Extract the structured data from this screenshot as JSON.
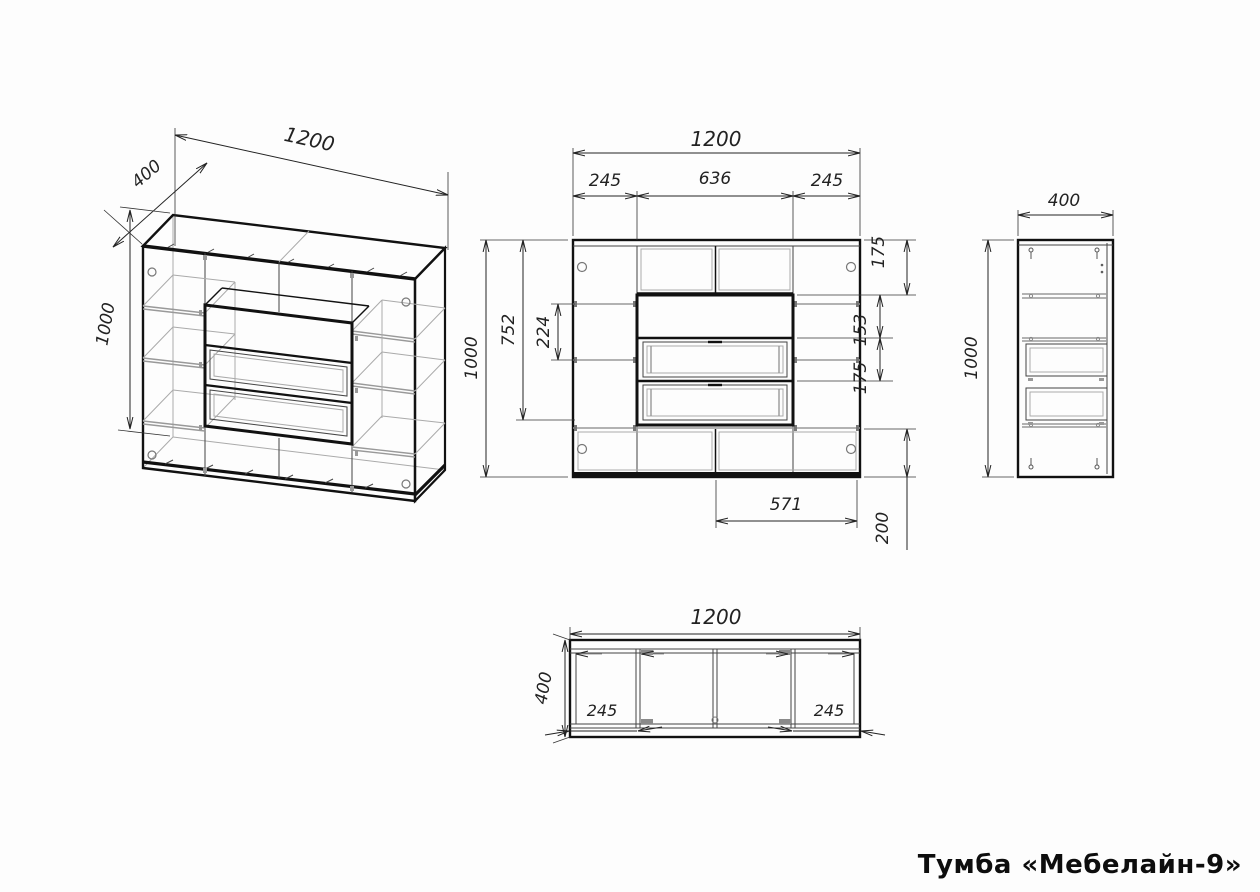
{
  "title": "Тумба «Мебелайн-9»",
  "drawing": {
    "isometric": {
      "width": "1200",
      "depth": "400",
      "height": "1000"
    },
    "front": {
      "overall_width": "1200",
      "left_bay": "245",
      "center_bay": "636",
      "right_bay": "245",
      "overall_height": "1000",
      "inner_height": "752",
      "shelf_spacing": "224",
      "top_section": "175",
      "niche_opening": "153",
      "drawer_height": "175",
      "bottom_section": "200",
      "door_width": "571"
    },
    "side": {
      "depth": "400",
      "height": "1000"
    },
    "plan": {
      "width": "1200",
      "depth": "400",
      "left_bay": "245",
      "right_bay": "245"
    }
  }
}
